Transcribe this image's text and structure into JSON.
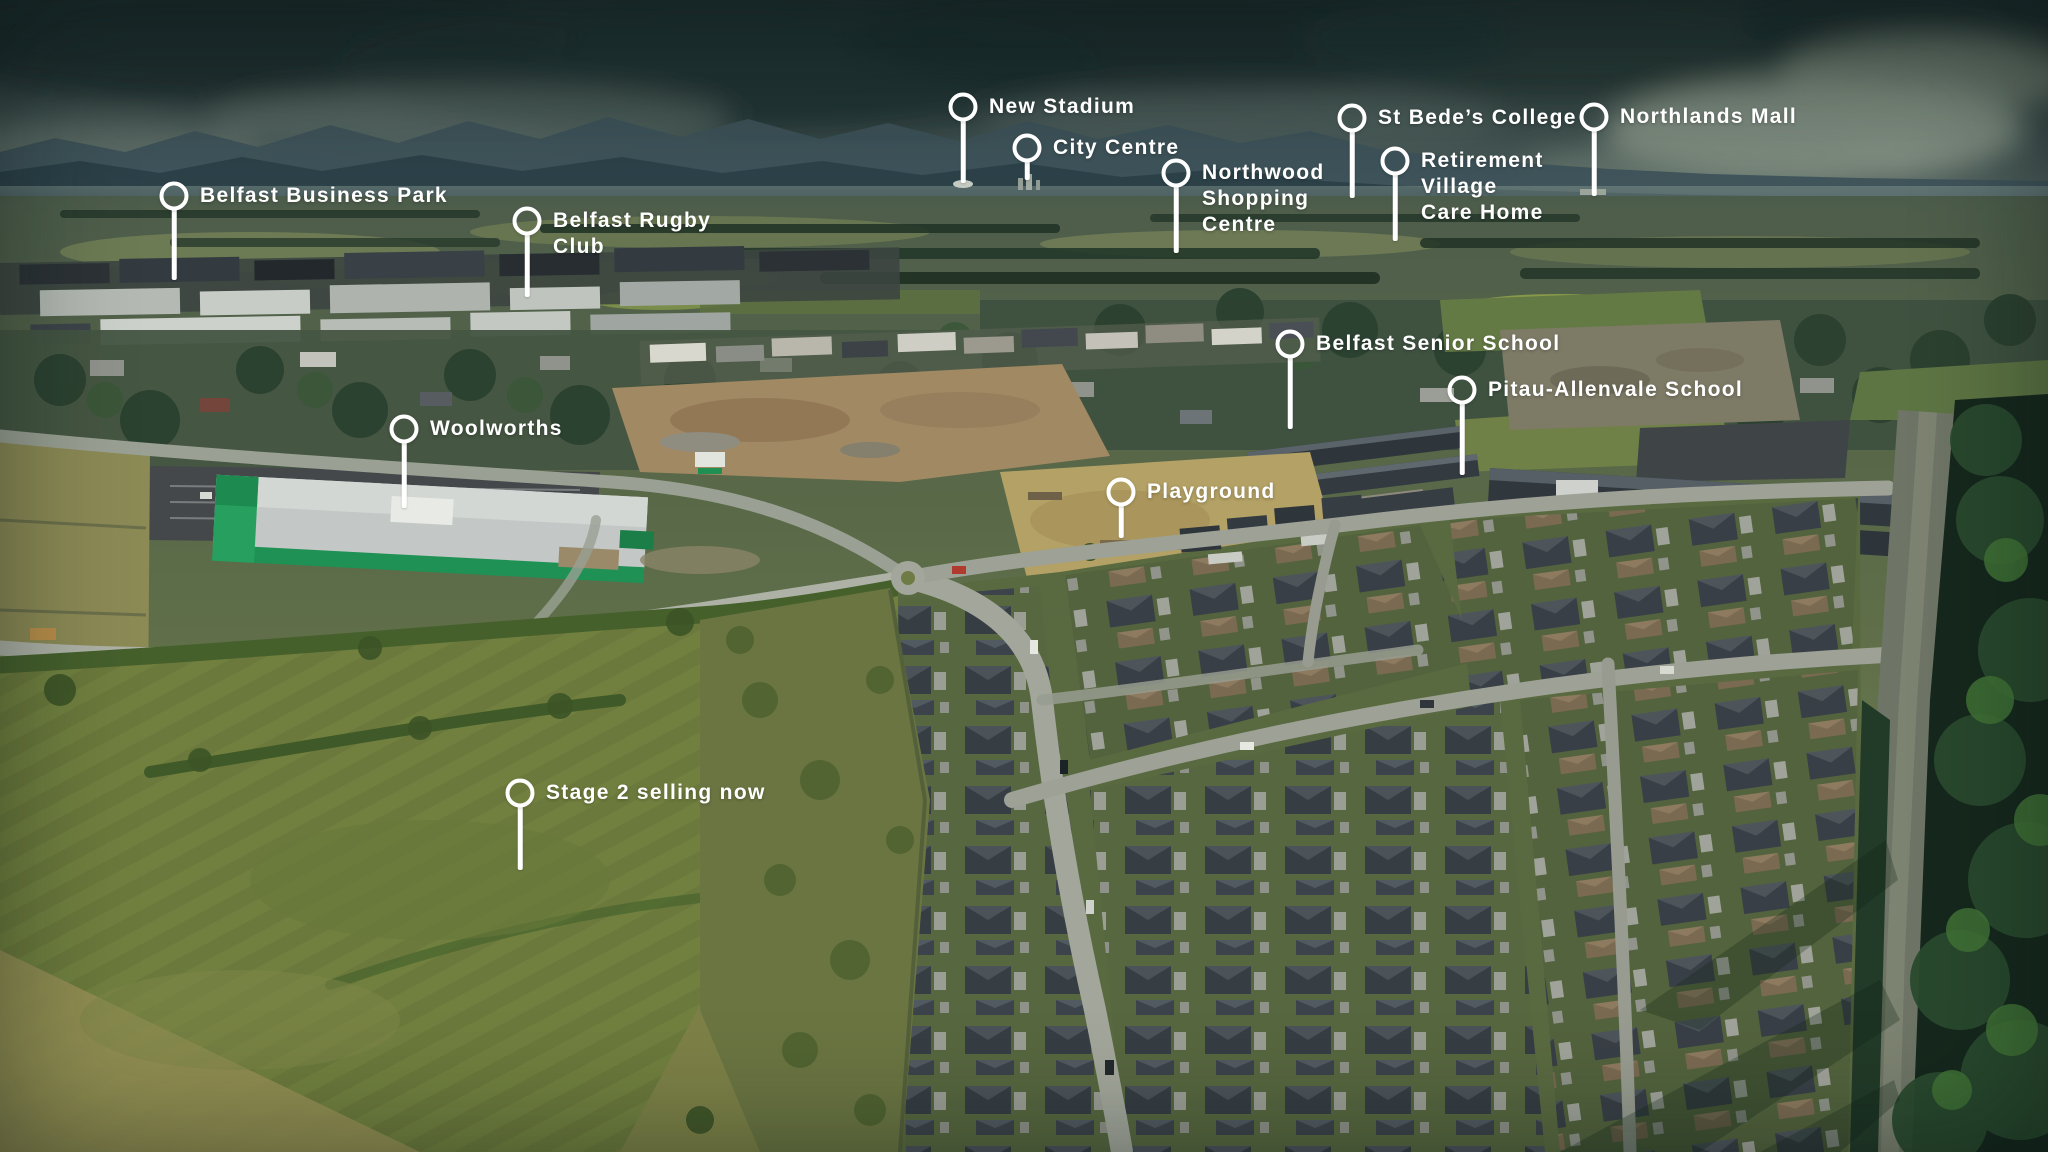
{
  "scene": {
    "type": "aerial-photo-location-map",
    "pin_icon": "circle-pin-with-stem"
  },
  "colors": {
    "pin": "#ffffff",
    "label_text": "#ffffff",
    "woolworths_green": "#1f9155",
    "roof_charcoal": "#373e44",
    "field_green": "#71803f",
    "sky_teal": "#3c4e4c"
  },
  "pins": [
    {
      "id": "belfast-business-park",
      "label_lines": [
        "Belfast Business Park"
      ],
      "x": 174,
      "y": 196,
      "stem": 84
    },
    {
      "id": "belfast-rugby-club",
      "label_lines": [
        "Belfast Rugby",
        "Club"
      ],
      "x": 527,
      "y": 221,
      "stem": 76
    },
    {
      "id": "new-stadium",
      "label_lines": [
        "New Stadium"
      ],
      "x": 963,
      "y": 107,
      "stem": 76
    },
    {
      "id": "city-centre",
      "label_lines": [
        "City Centre"
      ],
      "x": 1027,
      "y": 148,
      "stem": 32
    },
    {
      "id": "northwood-shopping-centre",
      "label_lines": [
        "Northwood",
        "Shopping",
        "Centre"
      ],
      "x": 1176,
      "y": 173,
      "stem": 80
    },
    {
      "id": "st-bedes-college",
      "label_lines": [
        "St Bede’s College"
      ],
      "x": 1352,
      "y": 118,
      "stem": 80
    },
    {
      "id": "northlands-mall",
      "label_lines": [
        "Northlands Mall"
      ],
      "x": 1594,
      "y": 117,
      "stem": 79
    },
    {
      "id": "retirement-village-care-home",
      "label_lines": [
        "Retirement",
        "Village",
        "Care Home"
      ],
      "x": 1395,
      "y": 161,
      "stem": 80
    },
    {
      "id": "belfast-senior-school",
      "label_lines": [
        "Belfast Senior School"
      ],
      "x": 1290,
      "y": 344,
      "stem": 85
    },
    {
      "id": "pitau-allenvale-school",
      "label_lines": [
        "Pitau-Allenvale School"
      ],
      "x": 1462,
      "y": 390,
      "stem": 85
    },
    {
      "id": "woolworths",
      "label_lines": [
        "Woolworths"
      ],
      "x": 404,
      "y": 429,
      "stem": 79
    },
    {
      "id": "playground",
      "label_lines": [
        "Playground"
      ],
      "x": 1121,
      "y": 492,
      "stem": 46
    },
    {
      "id": "stage-2-selling-now",
      "label_lines": [
        "Stage 2 selling now"
      ],
      "x": 520,
      "y": 793,
      "stem": 77
    }
  ]
}
